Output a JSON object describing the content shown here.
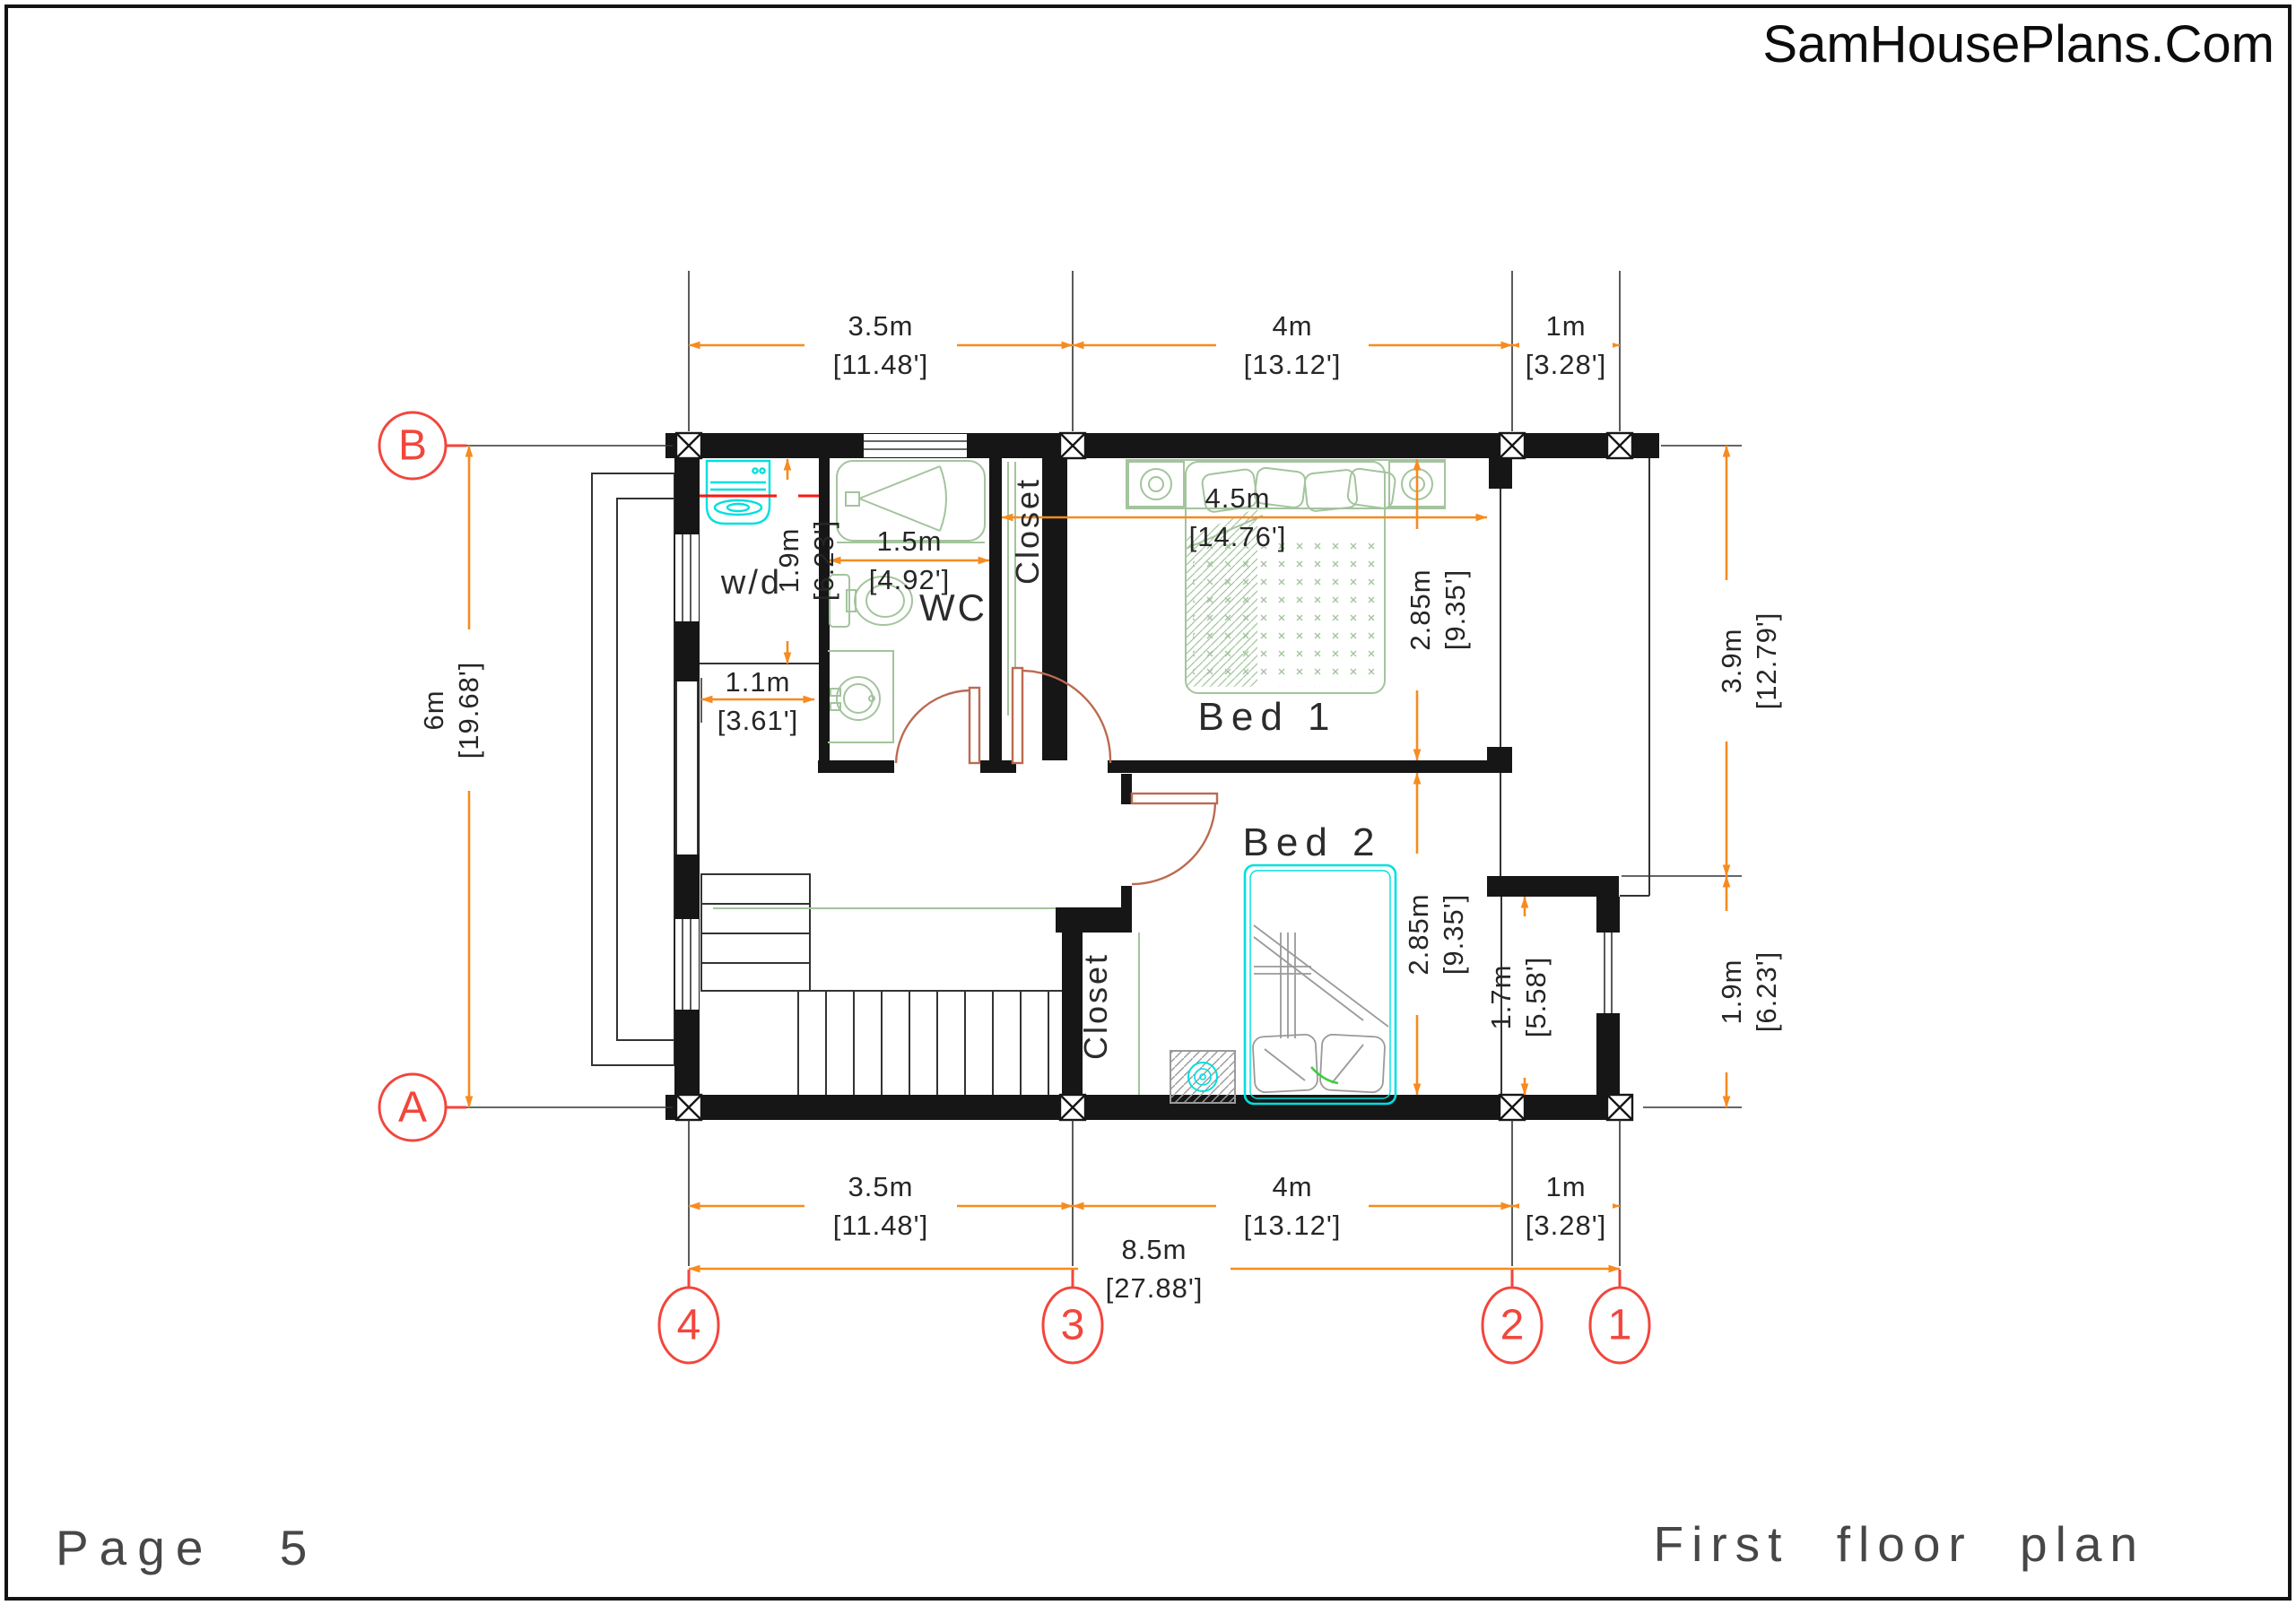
{
  "header": {
    "brand": "SamHousePlans.Com"
  },
  "footer": {
    "page_label": "Page 5",
    "title": "First floor plan"
  },
  "grid": {
    "columns": [
      "4",
      "3",
      "2",
      "1"
    ],
    "row_top": "B",
    "row_bottom": "A"
  },
  "rooms": {
    "wd": "w/d",
    "wc": "WC",
    "closet_top": "Closet",
    "bed1": "Bed 1",
    "bed2": "Bed 2",
    "closet_bottom": "Closet"
  },
  "dimensions": {
    "col_spans": [
      {
        "m": "3.5m",
        "ft": "[11.48']"
      },
      {
        "m": "4m",
        "ft": "[13.12']"
      },
      {
        "m": "1m",
        "ft": "[3.28']"
      }
    ],
    "col_total": {
      "m": "8.5m",
      "ft": "[27.88']"
    },
    "left": {
      "m": "6m",
      "ft": "[19.68']"
    },
    "right_spans": [
      {
        "m": "3.9m",
        "ft": "[12.79']"
      },
      {
        "m": "1.9m",
        "ft": "[6.23']"
      }
    ],
    "interior": {
      "wd_v": {
        "m": "1.9m",
        "ft": "[6.23']"
      },
      "wd_h": {
        "m": "1.1m",
        "ft": "[3.61']"
      },
      "wc": {
        "m": "1.5m",
        "ft": "[4.92']"
      },
      "bed1_w": {
        "m": "4.5m",
        "ft": "[14.76']"
      },
      "bed1_h": {
        "m": "2.85m",
        "ft": "[9.35']"
      },
      "bed2_h": {
        "m": "2.85m",
        "ft": "[9.35']"
      },
      "right_room": {
        "m": "1.7m",
        "ft": "[5.58']"
      }
    }
  },
  "colors": {
    "wall": "#161616",
    "dimension_orange": "#F68B1F",
    "grid_marker_red": "#F2463C",
    "furniture_green": "#A3C49D",
    "fixture_cyan": "#00DFDF",
    "door_sienna": "#BA6B52",
    "section_red": "#FF1511"
  }
}
